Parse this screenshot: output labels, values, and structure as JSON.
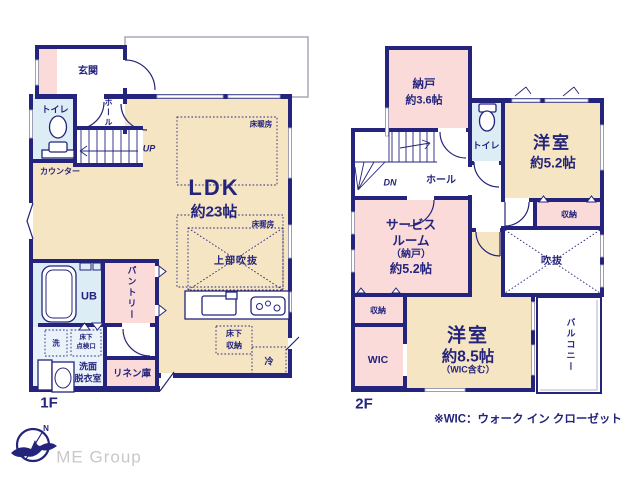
{
  "colors": {
    "navy": "#24247c",
    "beige": "#f6e5c2",
    "pink": "#fadbda",
    "light_blue": "#ddedf6",
    "washroom_blue": "#eaf3fa",
    "window_gray": "#9f9fb4",
    "brand_gray": "#c8c8c8"
  },
  "f1": {
    "floor": "1F",
    "genkan": "玄関",
    "toilet": "トイレ",
    "hall": "ホール",
    "up": "UP",
    "counter": "カウンター",
    "ldk": "LDK",
    "ldk_area": "約23帖",
    "floor_heat": "床暖房",
    "void_above": "上部吹抜",
    "ub": "UB",
    "pantry": "パントリー",
    "washer": "洗",
    "hatch1": "床下",
    "hatch2": "点検口",
    "wash1": "洗面",
    "wash2": "脱衣室",
    "linen": "リネン庫",
    "ps": "PS",
    "ufs1": "床下",
    "ufs2": "収納",
    "fridge": "冷"
  },
  "f2": {
    "floor": "2F",
    "nando": "納戸",
    "nando_area": "約3.6帖",
    "dn": "DN",
    "hall": "ホール",
    "toilet": "トイレ",
    "room52": "洋室",
    "room52_area": "約5.2帖",
    "closet": "収納",
    "void": "吹抜",
    "svc1": "サービス",
    "svc2": "ルーム",
    "svc3": "（納戸）",
    "svc4": "約5.2帖",
    "closet2": "収納",
    "wic": "WIC",
    "room85": "洋室",
    "room85_area": "約8.5帖",
    "room85_note": "（WIC含む）",
    "balcony": "バルコニー"
  },
  "footer": {
    "note": "※WIC：ウォーク イン クローゼット",
    "brand": "ME Group",
    "compass": "N"
  }
}
